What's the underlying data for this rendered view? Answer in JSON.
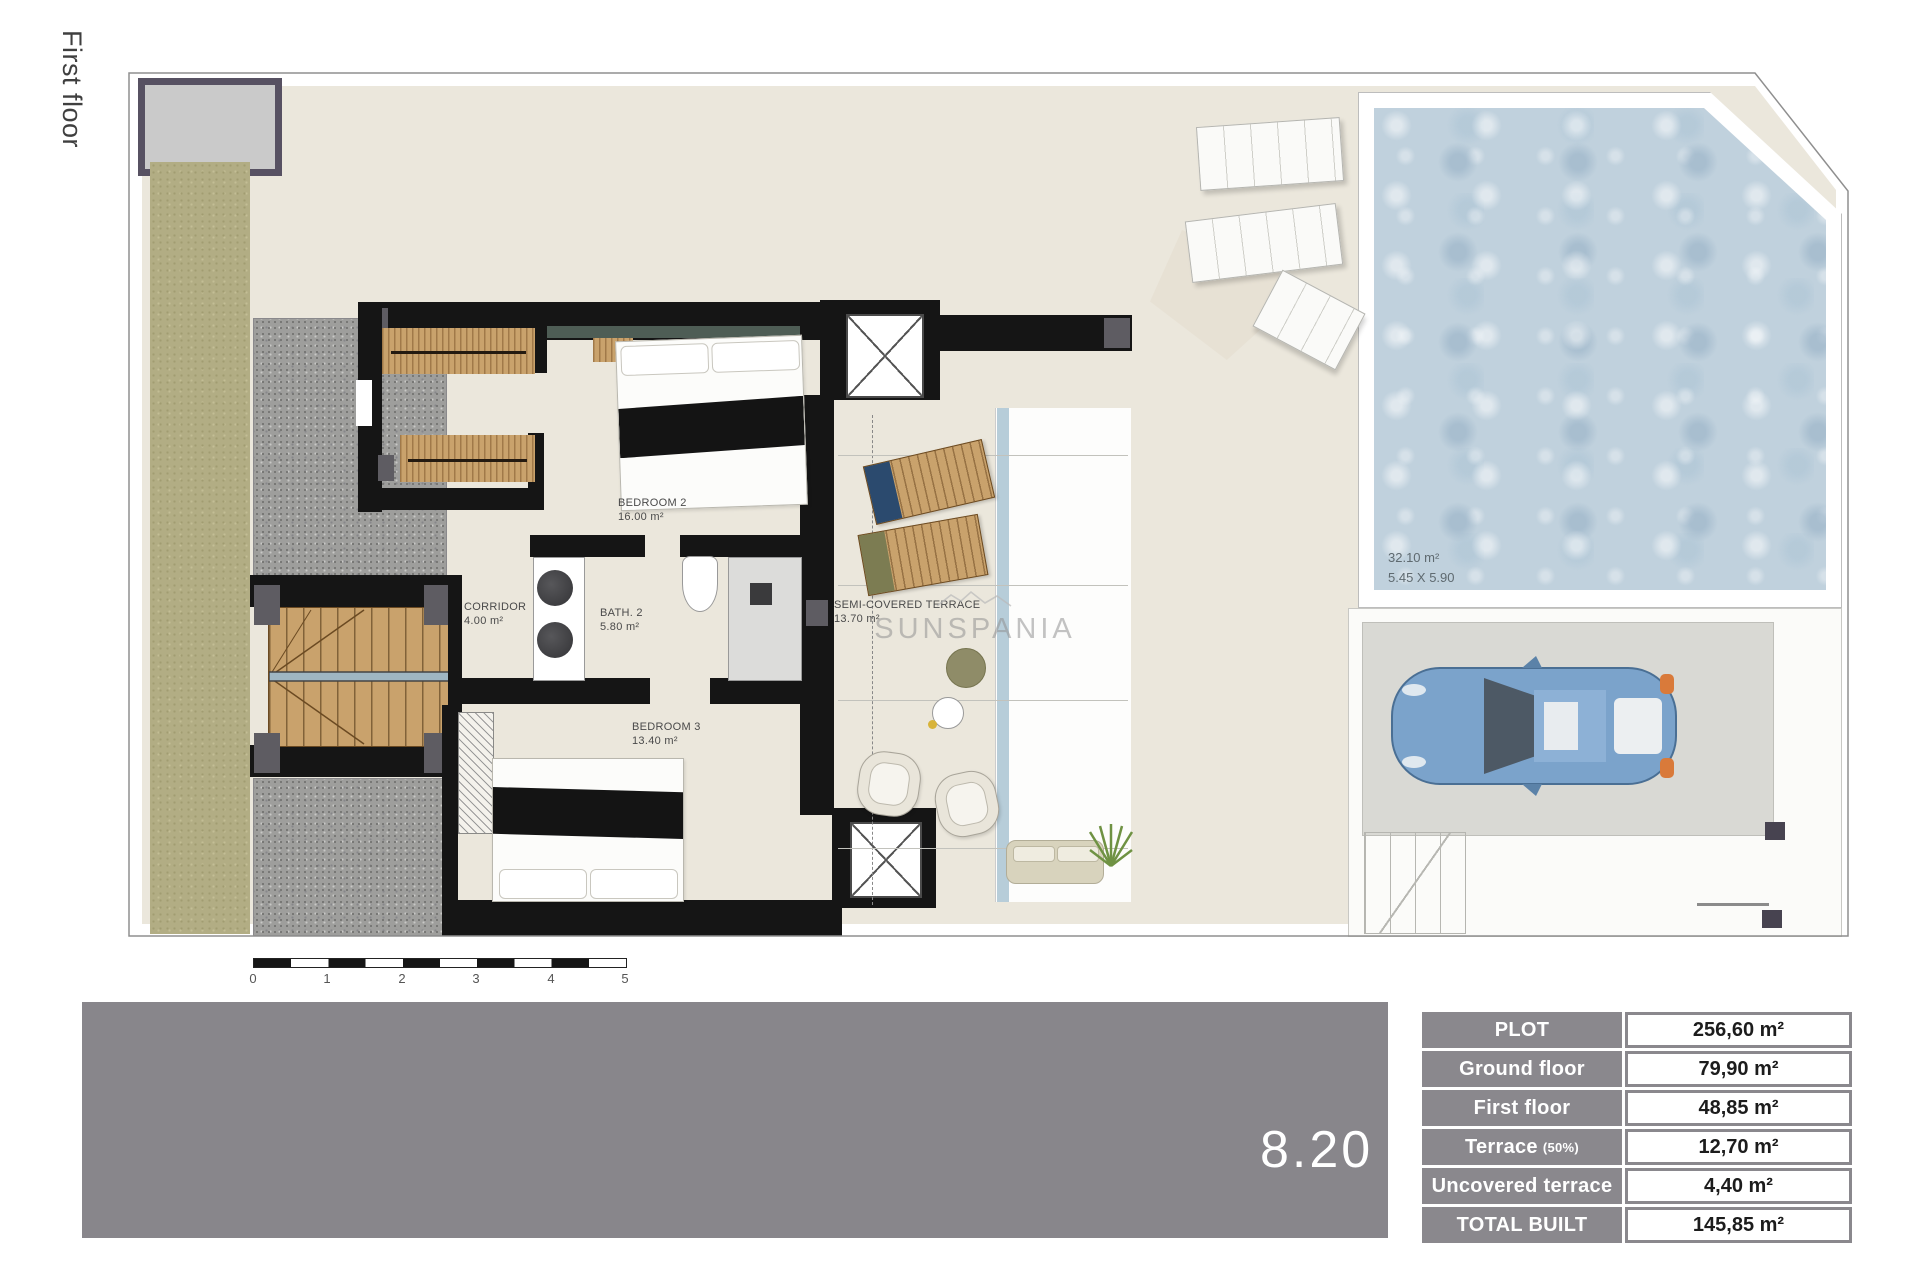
{
  "page": {
    "floor_label": "First floor",
    "plan_number": "8.20"
  },
  "rooms": [
    {
      "name": "BEDROOM 2",
      "area": "16.00 m²"
    },
    {
      "name": "CORRIDOR",
      "area": "4.00 m²"
    },
    {
      "name": "BATH. 2",
      "area": "5.80 m²"
    },
    {
      "name": "BEDROOM 3",
      "area": "13.40 m²"
    },
    {
      "name": "SEMI-COVERED TERRACE",
      "area": "13.70 m²"
    }
  ],
  "pool": {
    "area": "32.10 m²",
    "dimensions": "5.45 X 5.90"
  },
  "watermark": "SUNSPANIA",
  "scale_bar": {
    "ticks": [
      "0",
      "1",
      "2",
      "3",
      "4",
      "5"
    ]
  },
  "areas_table": {
    "rows": [
      {
        "label": "PLOT",
        "value": "256,60 m²"
      },
      {
        "label": "Ground floor",
        "value": "79,90 m²"
      },
      {
        "label": "First floor",
        "value": "48,85 m²"
      },
      {
        "label": "Terrace",
        "label_suffix": "(50%)",
        "value": "12,70 m²"
      },
      {
        "label": "Uncovered terrace",
        "value": "4,40 m²"
      },
      {
        "label": "TOTAL BUILT",
        "value": "145,85 m²"
      }
    ]
  },
  "colors": {
    "wall": "#151515",
    "wood": "#c9a26c",
    "grass": "#b2ad84",
    "gravel": "#9e9e9c",
    "pool_water": "#c0d1dd",
    "band_gray": "#88868b",
    "table_gray": "#8a888d",
    "car_blue": "#7ba3cb",
    "plot_cream": "#ebe7dc"
  }
}
